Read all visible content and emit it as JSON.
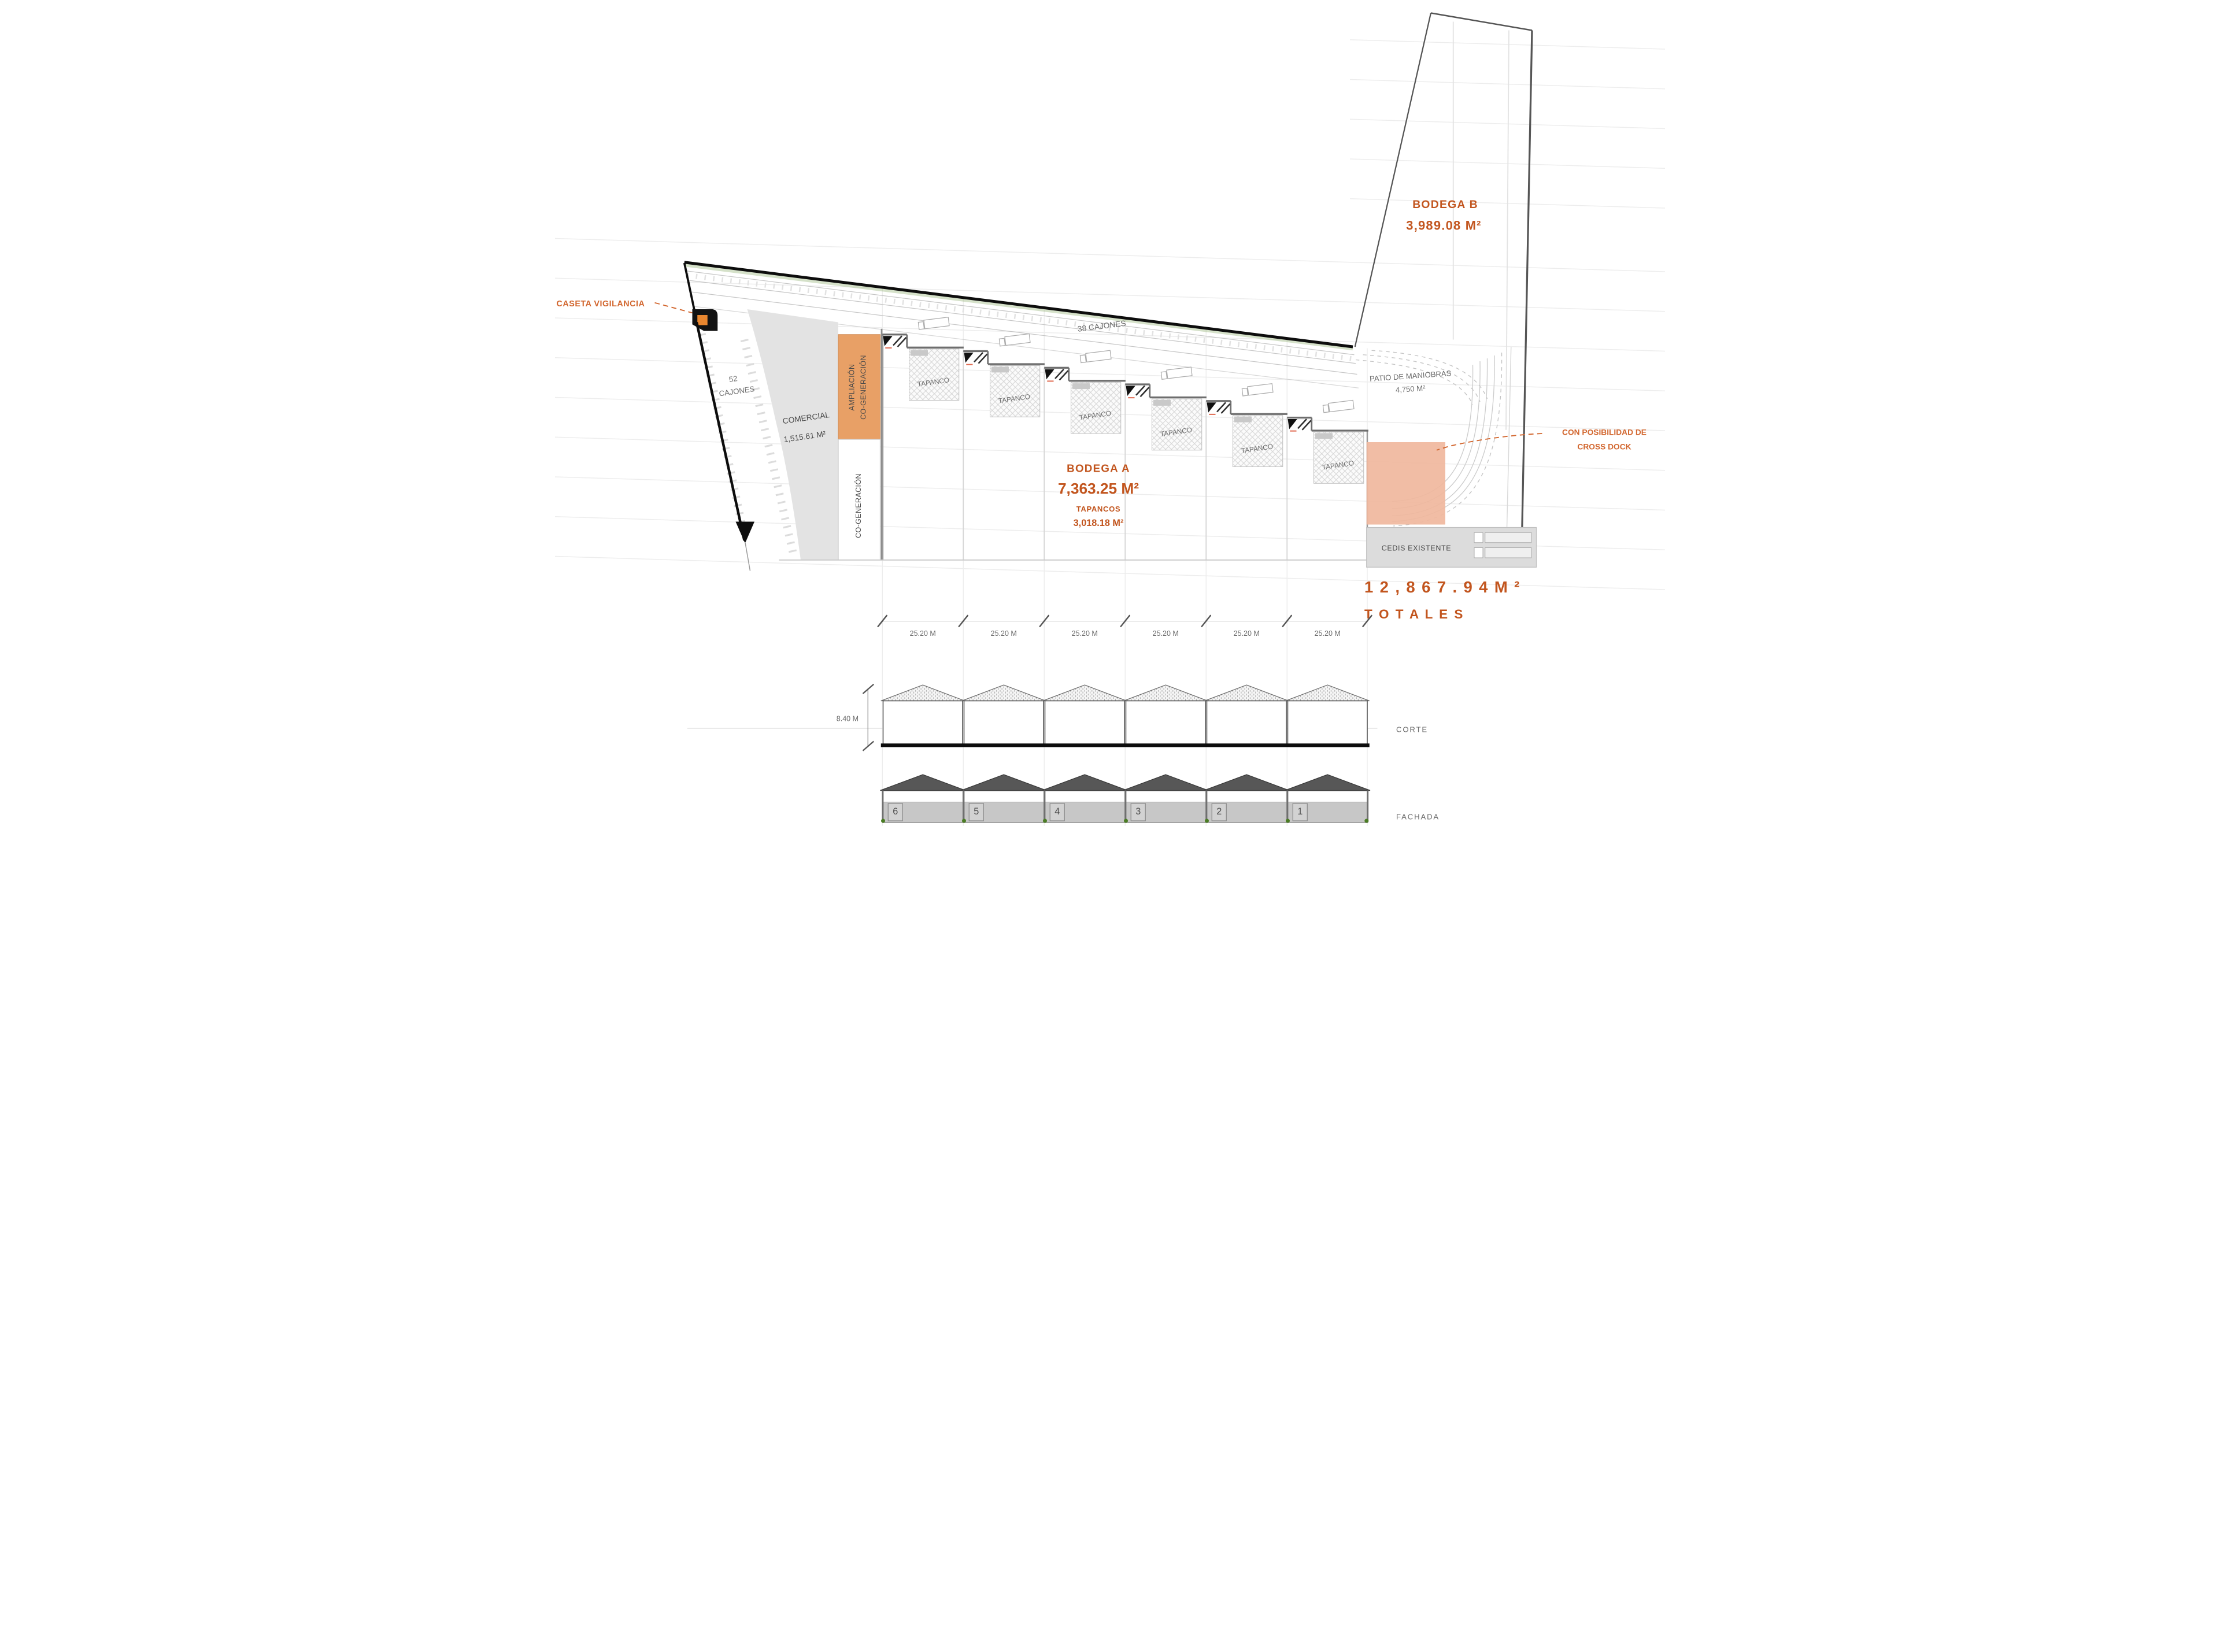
{
  "title": "Plano de conjunto - proyecto industrial",
  "colors": {
    "accent_orange_text": "#C2551E",
    "leader_orange": "#D2662E",
    "ampliacion_fill": "#E8A066",
    "crossdock_fill": "#F0B79D",
    "comercial_fill": "#E2E2E2",
    "cedis_fill": "#DCDCDC",
    "roof_dark": "#575757",
    "guard_booth_orange": "#E8862F",
    "landscape_green": "#4a7c24"
  },
  "plan": {
    "caseta_label": "CASETA VIGILANCIA",
    "cajones_strip": {
      "line1": "52",
      "line2": "CAJONES"
    },
    "cajones_road": "38 CAJONES",
    "comercial": {
      "name": "COMERCIAL",
      "area": "1,515.61 M²"
    },
    "ampliacion": {
      "line1": "AMPLIACIÓN",
      "line2": "CO-GENERACIÓN"
    },
    "cogeneracion": "CO-GENERACIÓN",
    "tapanco_label": "TAPANCO",
    "bodega_a": {
      "name": "BODEGA A",
      "area": "7,363.25 M²",
      "sub": "TAPANCOS",
      "sub_area": "3,018.18 M²"
    },
    "bodega_b": {
      "name": "BODEGA B",
      "area": "3,989.08 M²"
    },
    "patio": {
      "name": "PATIO DE MANIOBRAS",
      "area": "4,750 M²"
    },
    "cross_dock": {
      "line1": "CON POSIBILIDAD DE",
      "line2": "CROSS DOCK"
    },
    "cedis_label": "CEDIS EXISTENTE",
    "totals": {
      "area": "1 2 , 8 6 7 . 9 4   M ²",
      "label": "T O T A L E S"
    }
  },
  "dimensions": {
    "module_widths": [
      "25.20 M",
      "25.20 M",
      "25.20 M",
      "25.20 M",
      "25.20 M",
      "25.20 M"
    ],
    "building_height": "8.40 M"
  },
  "sections": {
    "corte_label": "CORTE",
    "fachada_label": "FACHADA",
    "unit_numbers": [
      "6",
      "5",
      "4",
      "3",
      "2",
      "1"
    ]
  }
}
